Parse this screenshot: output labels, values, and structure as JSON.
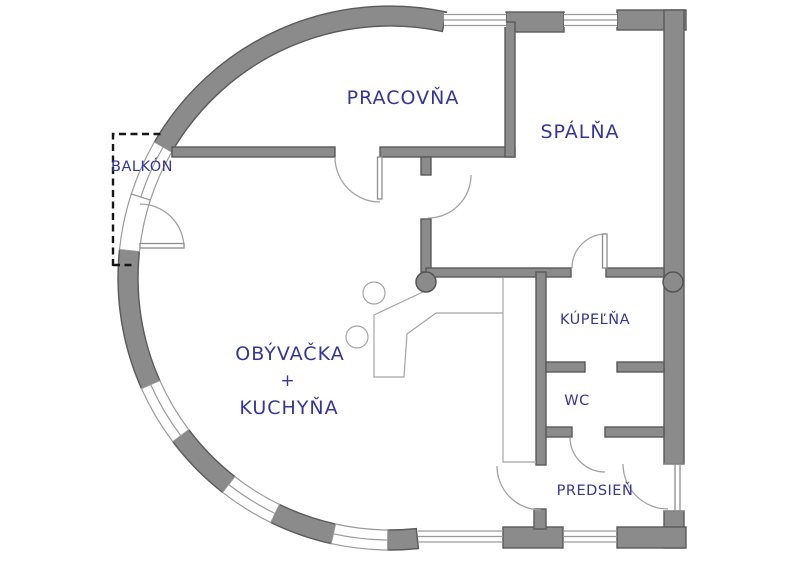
{
  "plan": {
    "type": "apartment-floor-plan",
    "language": "sk",
    "colors": {
      "wall_fill": "#8b8b8b",
      "wall_outline": "#5a5a5a",
      "label_text": "#3434a3",
      "thin_line": "#9a9a9a",
      "balcony_dash": "#161616",
      "background": "#ffffff"
    },
    "rooms": {
      "balcony": {
        "label": "BALKÓN"
      },
      "study": {
        "label": "PRACOVŇA"
      },
      "bedroom": {
        "label": "SPÁLŇA"
      },
      "living_kitchen": {
        "label_top": "OBÝVAČKA",
        "label_plus": "+",
        "label_bottom": "KUCHYŇA"
      },
      "bathroom": {
        "label": "KÚPEĽŇA"
      },
      "wc": {
        "label": "WC"
      },
      "hallway": {
        "label": "PREDSIEŇ"
      }
    }
  }
}
